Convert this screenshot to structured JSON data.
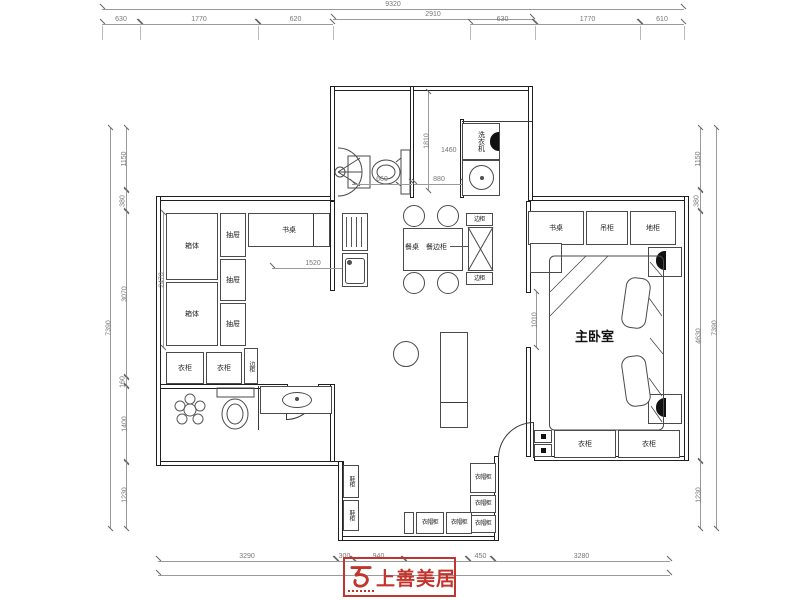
{
  "logo": {
    "brand": "上善美居"
  },
  "rooms": {
    "master_bedroom": "主卧室"
  },
  "furniture": {
    "washing_machine": "洗衣机",
    "desk_study": "书桌",
    "desk_master": "书桌",
    "hanging_cabinet": "吊柜",
    "floor_cabinet": "地柜",
    "dining_table": "餐桌",
    "sideboard": "餐边柜",
    "side_cabinets": [
      "边柜",
      "边柜",
      "边柜"
    ],
    "tatami_boxes": [
      "箱体",
      "箱体"
    ],
    "drawers": [
      "抽屉",
      "抽屉",
      "抽屉"
    ],
    "wardrobes": [
      "衣柜",
      "衣柜",
      "衣柜",
      "衣柜"
    ],
    "cloak_cabinets": [
      "衣帽柜",
      "衣帽柜",
      "衣帽柜",
      "衣帽柜",
      "衣帽柜"
    ],
    "shoe_cabinets": [
      "鞋柜",
      "鞋柜"
    ]
  },
  "dims": {
    "top": {
      "total": "9320",
      "mid": "2910",
      "left": [
        "630",
        "1770",
        "620"
      ],
      "right": [
        "630",
        "1770",
        "610"
      ]
    },
    "left": {
      "total": "7390",
      "chain": [
        "1150",
        "380",
        "3070",
        "160",
        "1400",
        "1230"
      ]
    },
    "right": {
      "total": "7390",
      "chain": [
        "1150",
        "380",
        "4630",
        "1230"
      ]
    },
    "bottom": {
      "chain": [
        "3290",
        "300",
        "940",
        "450",
        "3280"
      ]
    },
    "interior": {
      "bath_depth": "1810",
      "laundry": "1460",
      "shower": "660",
      "passage": "880",
      "tatami": "2470",
      "width": "1520",
      "opening": "1010"
    }
  },
  "colors": {
    "brand_red": "#c2342c",
    "wall": "#1f1f1f",
    "dim": "#777777"
  }
}
